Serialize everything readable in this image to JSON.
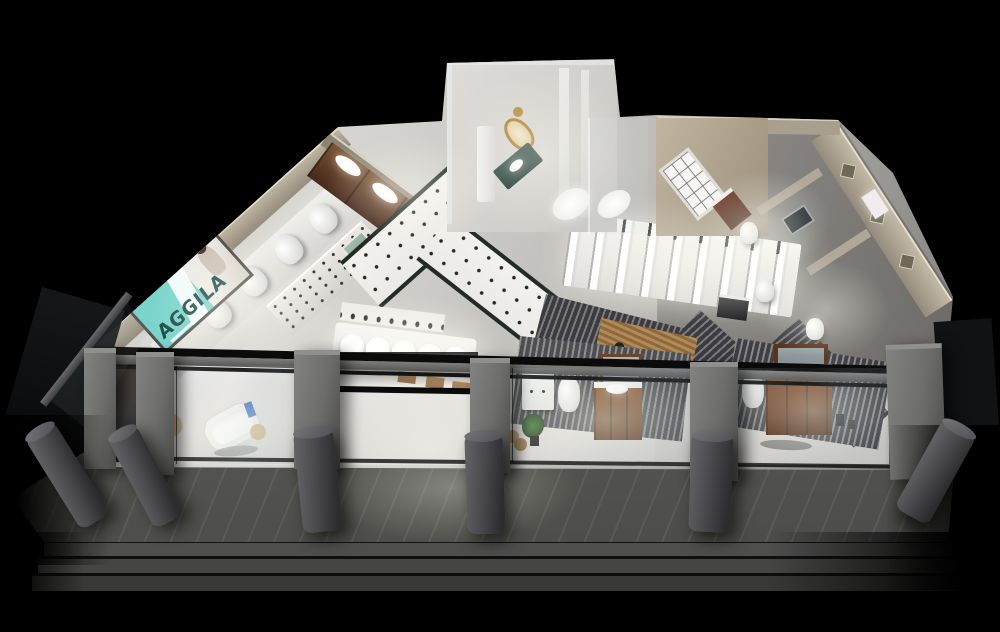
{
  "meta": {
    "type": "3d-architectural-rendering",
    "subject": "Aerial cutaway night render of a sanitary-ware (bathroom fixtures) showroom with glass storefront, exterior walkway, bollards and steps",
    "canvas": {
      "width": 1000,
      "height": 632
    },
    "background_color": "#000000"
  },
  "brand_sign": {
    "text": "AGGILA",
    "panel_color": "#7ad4cb",
    "text_color": "#1d4b48",
    "photo_panel": "woman in white photo collage"
  },
  "palette": {
    "floor_light": "#e3e1dd",
    "floor_mid": "#c6c4c0",
    "wall_beige": "#b3a994",
    "wood_dark": "#46291c",
    "wood_mid": "#8a572e",
    "frame_black": "#121212",
    "pillar_gray": "#6d6d6b",
    "bollard_gray": "#4a4a4c",
    "walkway_gray": "#5a5a56",
    "step_gray": "#454542",
    "slat_dark": "#3b3b40",
    "poster_green": "#9fb4a4",
    "counter_teal": "#2c4a42",
    "mirror_gold": "#a97f2e",
    "plant_green": "#3f6d35",
    "accent_blue": "#4579c2"
  },
  "counts": {
    "display_toilets_on_ledge": 5,
    "display_basins_on_table": 5,
    "wood_run_sinks": 4,
    "storefront_glass_bays": 4,
    "facade_pillars": 6,
    "bollards": 6,
    "exterior_steps": 3
  },
  "areas": {
    "left_wing": "brand wall with teal AGGILA sign and toilet display ledge",
    "wood_run": "classical dark-wood vanity run with inset basins",
    "faucet_wall": "white display wall with rows of faucets and green poster",
    "tile_paths": "white dotted ceramic tile walkways with dark borders",
    "basin_tables": "illuminated counter with five round wash basins and faucet shelf",
    "shower_display": "platform with rows of glass shower column panels",
    "luxury_room": "glass-walled luxury bath room with gold mirror, teal counter and tub",
    "french_room": "beige room with white french window and dark vanity",
    "right_wing": "bathroom vignettes with toilets, vanities and mirrors along diamond-decor wall",
    "storefront": "glass bays: bathtub scene, entrance with benches, white cabinet + wood vanity scene, wood vanity + mirror scene",
    "exterior": "stone walkway with cylindrical bollards and three long steps"
  }
}
